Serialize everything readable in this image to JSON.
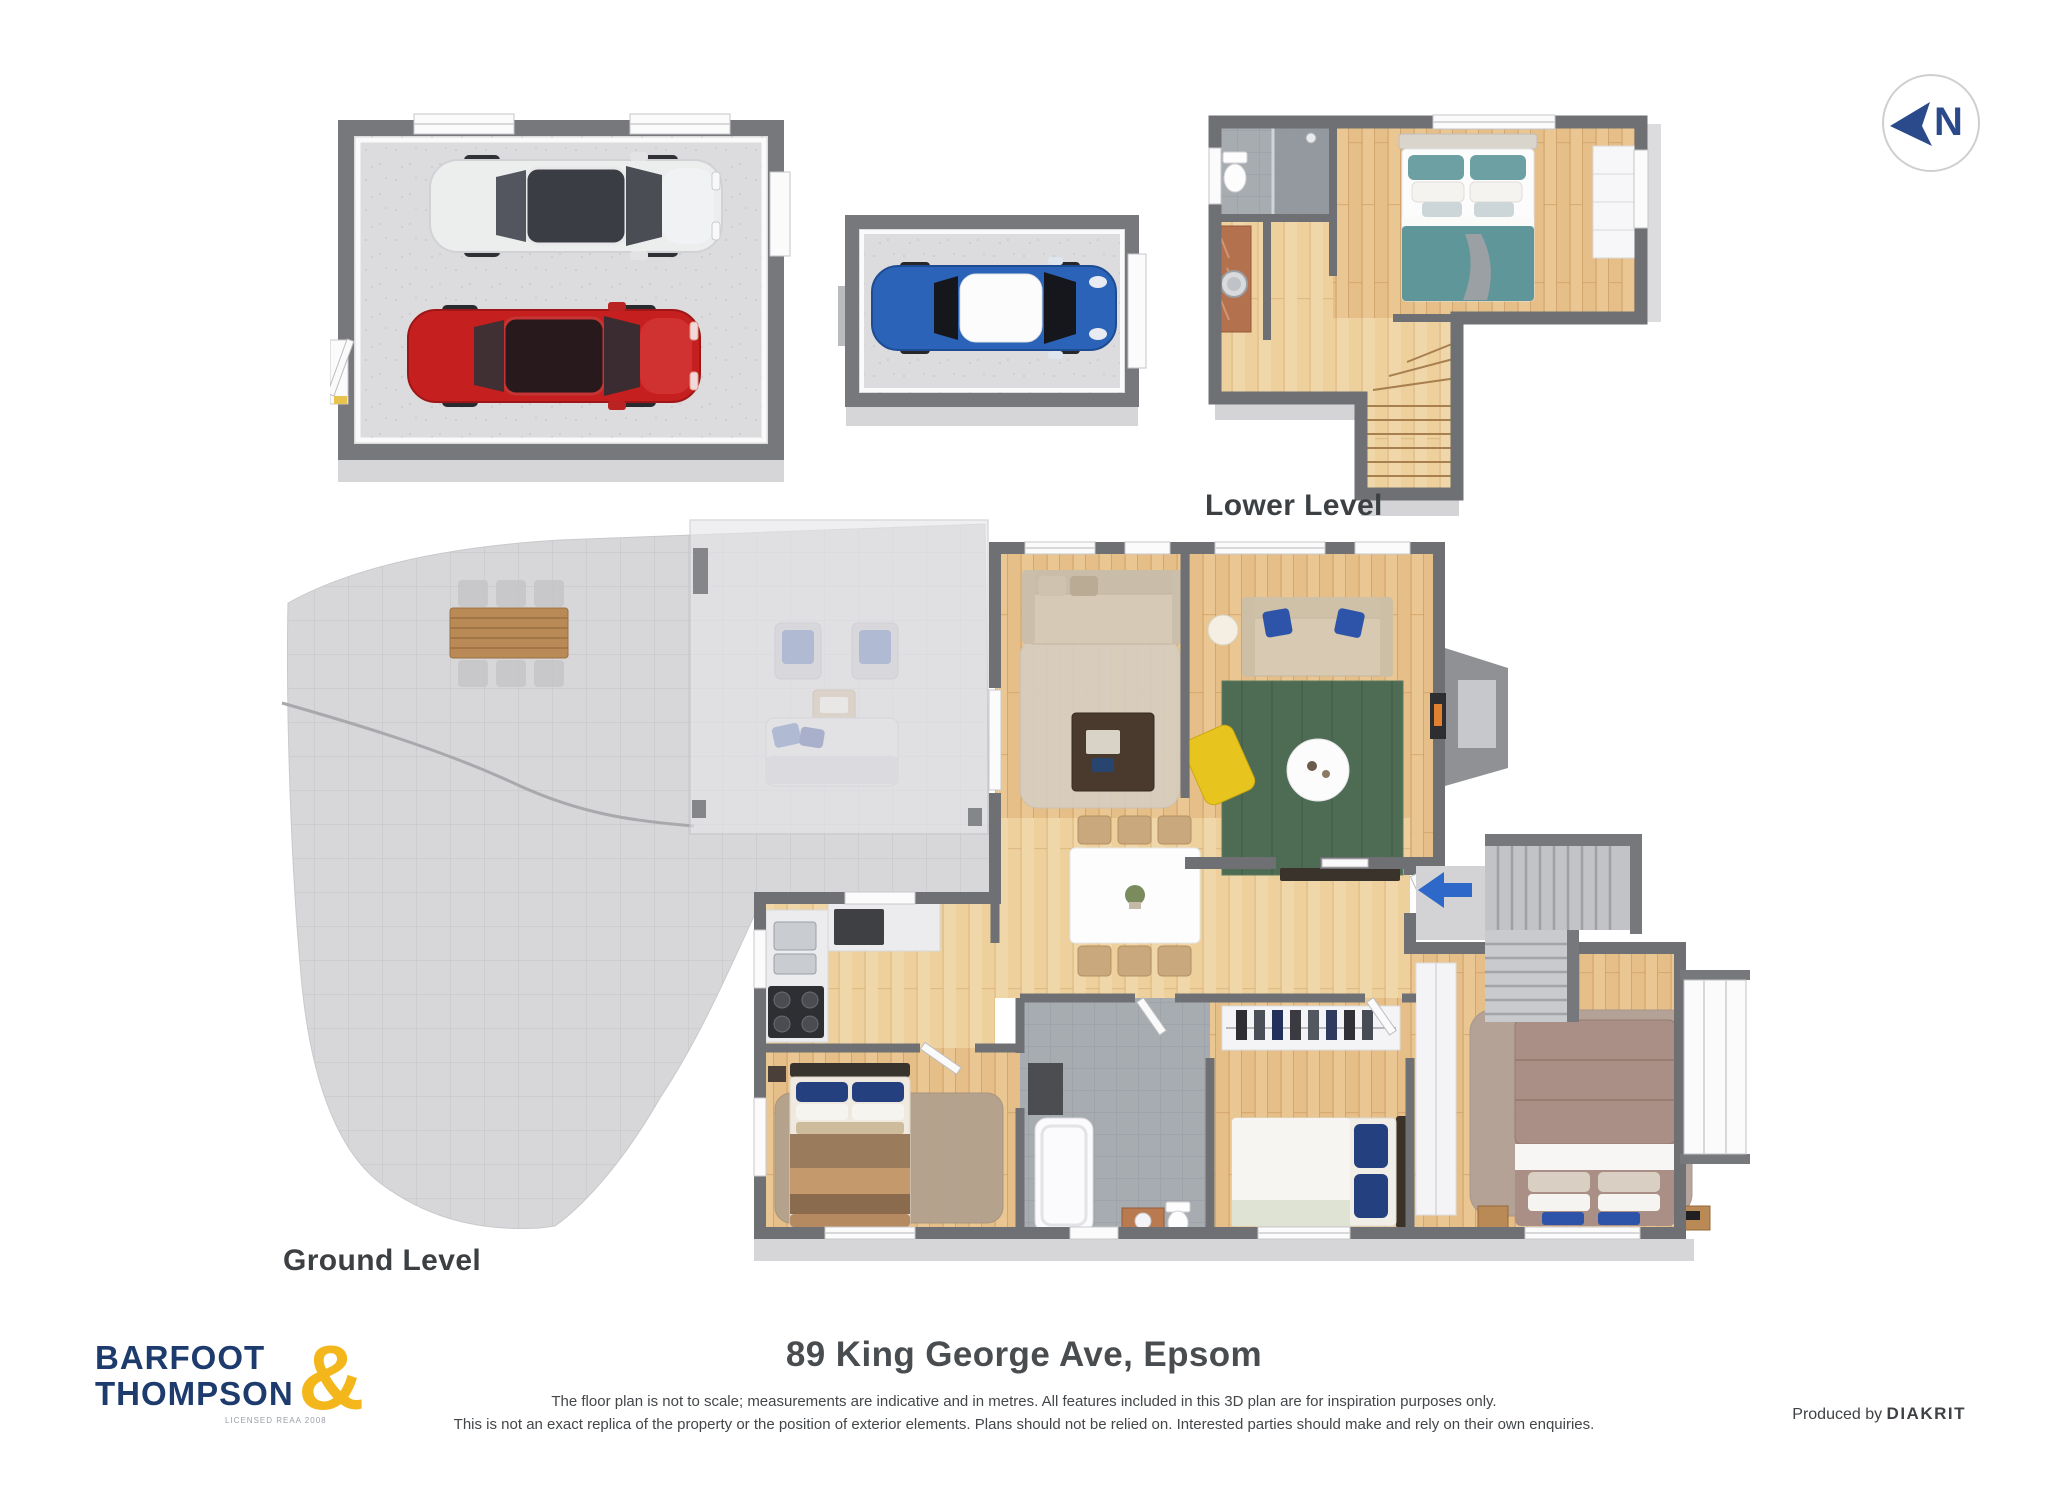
{
  "compass": {
    "letter": "N"
  },
  "labels": {
    "lower_level": "Lower Level",
    "ground_level": "Ground Level"
  },
  "footer": {
    "address": "89 King George Ave, Epsom",
    "disclaimer_line1": "The floor plan is not to scale; measurements are indicative and in metres. All features included in this 3D plan are for inspiration purposes only.",
    "disclaimer_line2": "This is not an exact replica of the property or the position of exterior elements. Plans should not be relied on. Interested parties should make and rely on their own enquiries.",
    "produced_by_prefix": "Produced by ",
    "producer": "DIAKRIT"
  },
  "logo": {
    "line1": "BARFOOT",
    "line2": "THOMPSON",
    "ampersand": "&",
    "license": "LICENSED REAA 2008"
  },
  "colors": {
    "brand_navy": "#1d3c6d",
    "brand_gold": "#f3b71c",
    "compass_blue": "#2a4a8c",
    "entry_arrow_blue": "#2e68c8",
    "wall_gray": "#6f7073",
    "wood_floor": "#eac792",
    "patio_gray": "#d7d7d9",
    "rug_green": "#4e6b53",
    "bed_teal": "#5f9699",
    "car_red": "#c51f1f",
    "car_blue": "#2a63b8",
    "car_white": "#eceded"
  }
}
